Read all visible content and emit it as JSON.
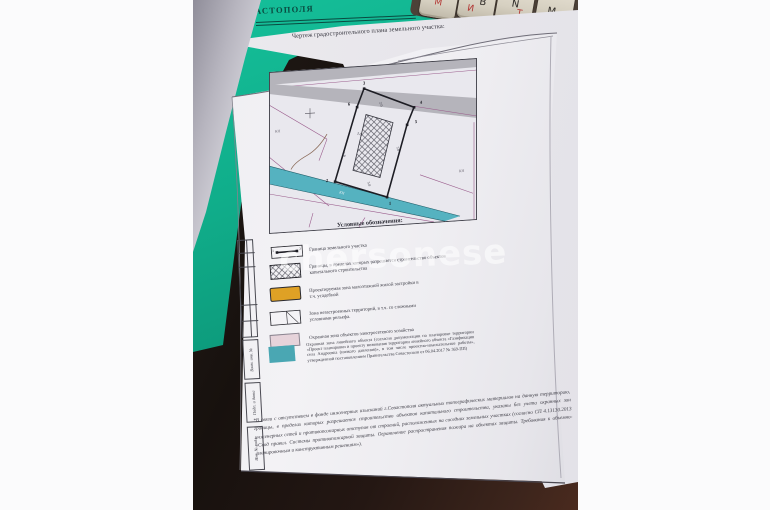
{
  "document": {
    "title": "Чертеж градостроительного плана земельного участка:",
    "legend_title": "Условные обозначения:",
    "legend": [
      {
        "symbol": "plot-boundary-symbol",
        "label": "Граница земельного участка"
      },
      {
        "symbol": "construction-limits-hatch-symbol",
        "label": "Границы, в пределах которых разрешается строительство объектов капитального строительства"
      },
      {
        "symbol": "low-rise-housing-zone-symbol",
        "label": "Проектируемая зона малоэтажной жилой застройки в т.ч. усадебной"
      },
      {
        "symbol": "undeveloped-territory-symbol",
        "label": "Зона незастроенных территорий, в т.ч. со сложными условиями рельефа."
      },
      {
        "symbol": "power-grid-protection-zone-symbol",
        "label": "Охранная зона объектов электросетевого хозяйства"
      },
      {
        "symbol": "linear-object-protection-zone-symbol",
        "label": "Охранная зона линейного объекта (согласно документации по планировке территории «Проект планировки и проекту межевания территории линейного объекта «Газификация села Андреевка (низкого давления)», в том числе проектно-изыскательные работы», утвержденной постановлением Правительства Севастополя от 06.04.2017 № 369-ПП)"
      }
    ],
    "footnote": "*В связи с отсутствием в фонде инженерных изысканий г.Севастополя актуальных топографических материалов на данную территорию, границы, в пределах которых разрешается строительство объектов капитального строительства, указаны без учета охранных зон инженерных сетей и противопожарных отступов от строений, расположенных на соседних земельных участках (согласно СП 4.13130.2013 «Свод правил. Системы противопожарной защиты. Ограничение распространения пожара на объектах защиты. Требования к объемно-планировочным и конструктивным решениям»).",
    "stamp_fields": [
      "Взам. инв. №",
      "Подп. и дата",
      "Инв. № подл."
    ],
    "map": {
      "vertex_labels": [
        "1",
        "2",
        "3",
        "4",
        "5",
        "6"
      ],
      "boundary_marker_numbers": [
        "1",
        "2"
      ],
      "dimensions": {
        "top": "2.0",
        "left": "2.0",
        "right": "3.0",
        "bottom": "5.0",
        "left_edge": "5.0"
      },
      "cadastral_label_left": "КН",
      "cadastral_label_right": "КН",
      "cadastral_label_band": "КН"
    }
  },
  "scene": {
    "folder_text": "АСТОПОЛЯ",
    "watermark": "chersonese",
    "keyboard_keys": [
      {
        "latin": "",
        "cyrillic": "М"
      },
      {
        "latin": "B",
        "cyrillic": "И"
      },
      {
        "latin": "N",
        "cyrillic": "Т"
      },
      {
        "latin": "M",
        "cyrillic": ""
      }
    ],
    "colors": {
      "folder_green": "#10ad8a",
      "map_teal_band": "#55b2c0",
      "legend_orange": "#dfa125",
      "legend_pink": "#e6d3da",
      "legend_teal": "#4aa7b3",
      "map_grey_band": "#b5b4bb",
      "map_pink_line": "#9a5c8c"
    }
  }
}
